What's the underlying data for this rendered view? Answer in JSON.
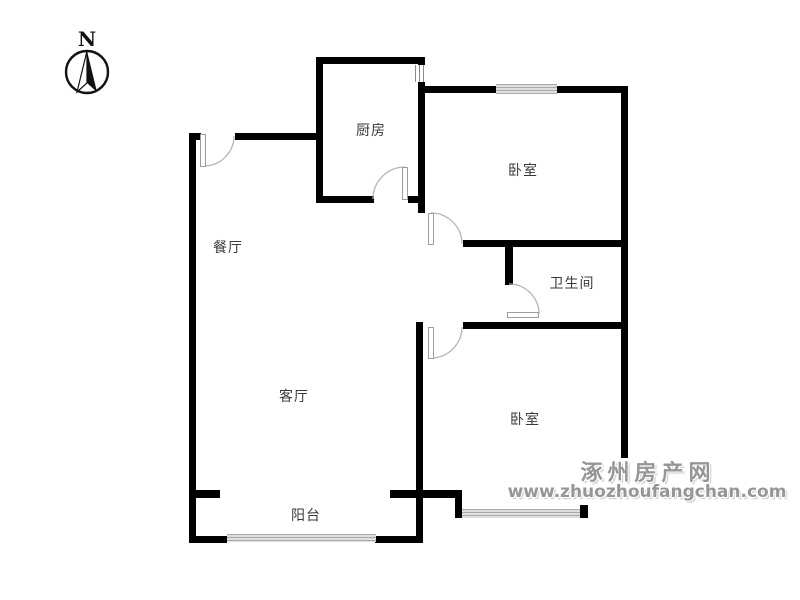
{
  "compass": {
    "label": "N"
  },
  "rooms": [
    {
      "id": "kitchen",
      "label": "厨房"
    },
    {
      "id": "bedroom-north",
      "label": "卧室"
    },
    {
      "id": "dining",
      "label": "餐厅"
    },
    {
      "id": "bathroom",
      "label": "卫生间"
    },
    {
      "id": "living",
      "label": "客厅"
    },
    {
      "id": "bedroom-south",
      "label": "卧室"
    },
    {
      "id": "balcony",
      "label": "阳台"
    }
  ],
  "watermark": {
    "site_name": "涿州房产网",
    "site_url": "www.zhuozhoufangchan.com"
  },
  "colors": {
    "wall": "#000000",
    "window": "#dcdcdc",
    "door_arc": "#b5b5b5",
    "label_text": "#3a3a3a",
    "watermark_text": "#969696"
  }
}
